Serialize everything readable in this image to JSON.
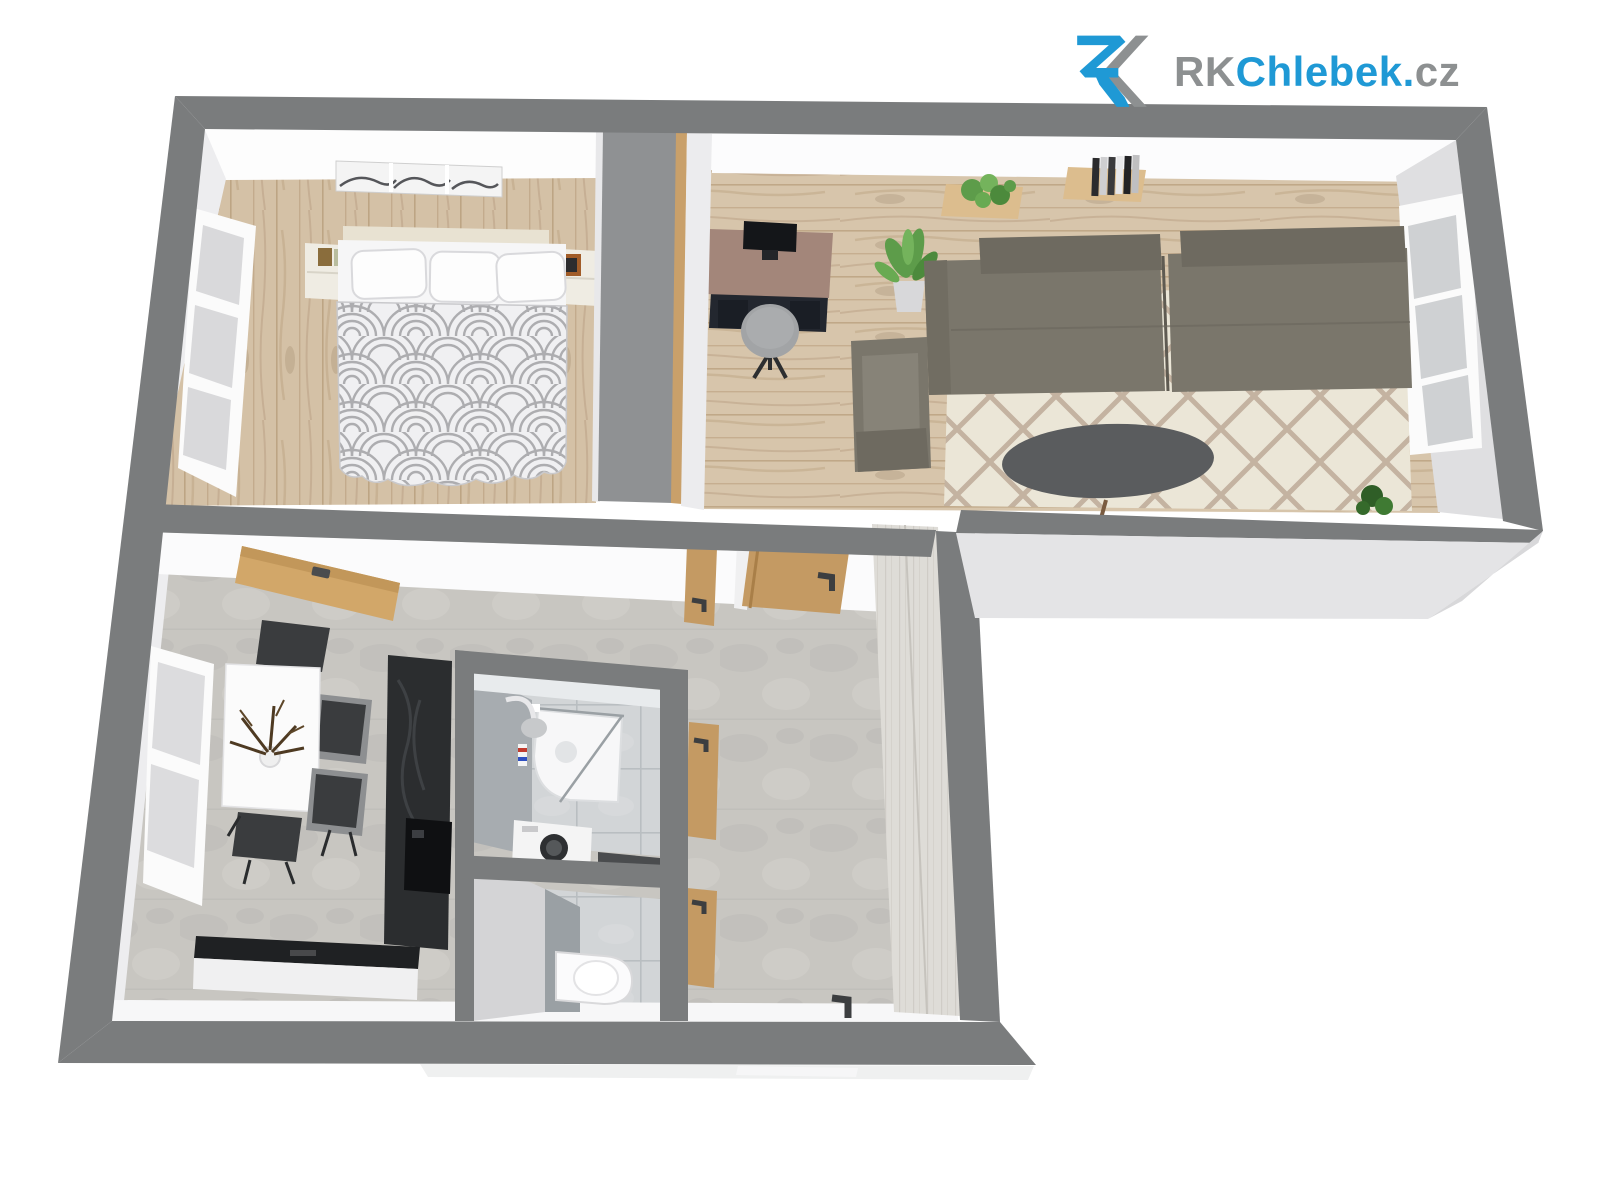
{
  "brand": {
    "icon": "rk-monogram-icon",
    "segments": [
      {
        "text": "RK",
        "color": "#8d9091"
      },
      {
        "text": "Chlebek",
        "color": "#1f99d5"
      },
      {
        "text": ".",
        "color": "#1f99d5"
      },
      {
        "text": "cz",
        "color": "#8d9091"
      }
    ],
    "brand_blue": "#1f99d5",
    "brand_gray": "#8d9091"
  },
  "scene": {
    "type": "3d-floorplan-top-view",
    "palette": {
      "wall_top": "#7a7c7d",
      "wall_exterior_face": "#e4e4e6",
      "interior_face": "#f6f6f7",
      "wood_floor": "#d3c0a5",
      "stone_floor": "#c8c6c1",
      "bath_tile": "#d2d5d7",
      "rug_base": "#ebe6d7",
      "rug_lattice": "#b7a28f",
      "sofa": "#7a766b",
      "coffee_table": "#5a5c5e",
      "desk_top": "#a3867a",
      "desk_base": "#23272f",
      "counter_dark": "#26282a",
      "door_wood": "#c49a63",
      "plant_green": "#5d9c4a"
    },
    "rooms": [
      {
        "name": "bedroom",
        "floor": "wood",
        "furniture": [
          "wall-art-triptych",
          "double-bed",
          "patterned-duvet",
          "pillow",
          "pillow",
          "pillow",
          "nightstand-left",
          "nightstand-right",
          "gray-wardrobe",
          "window-3-pane"
        ]
      },
      {
        "name": "living-room",
        "floor": "wood",
        "furniture": [
          "desk",
          "monitor",
          "desk-stool",
          "potted-plant",
          "sectional-sofa",
          "armchair",
          "oval-coffee-table",
          "diamond-area-rug",
          "wall-shelf-with-plant",
          "wall-shelf-with-books",
          "floor-plant",
          "window-3-pane"
        ]
      },
      {
        "name": "kitchen-dining",
        "floor": "stone",
        "furniture": [
          "wood-tall-cabinet",
          "dark-counter-side",
          "dark-counter-bottom",
          "built-in-appliance",
          "white-dining-table",
          "dried-plant-centerpiece",
          "dining-chair",
          "dining-chair",
          "dining-chair",
          "dining-chair",
          "window-3-pane"
        ]
      },
      {
        "name": "bathroom",
        "floor": "tile",
        "furniture": [
          "corner-shower",
          "shower-arm",
          "toiletries-bottle",
          "washing-machine",
          "dark-counter"
        ]
      },
      {
        "name": "wc",
        "floor": "tile",
        "furniture": [
          "toilet"
        ]
      },
      {
        "name": "hallway",
        "floor": "stone",
        "furniture": [
          "tall-light-wardrobe",
          "interior-wood-door",
          "interior-wood-door",
          "interior-wood-door",
          "open-wood-door",
          "entrance-door-handle"
        ]
      }
    ]
  }
}
